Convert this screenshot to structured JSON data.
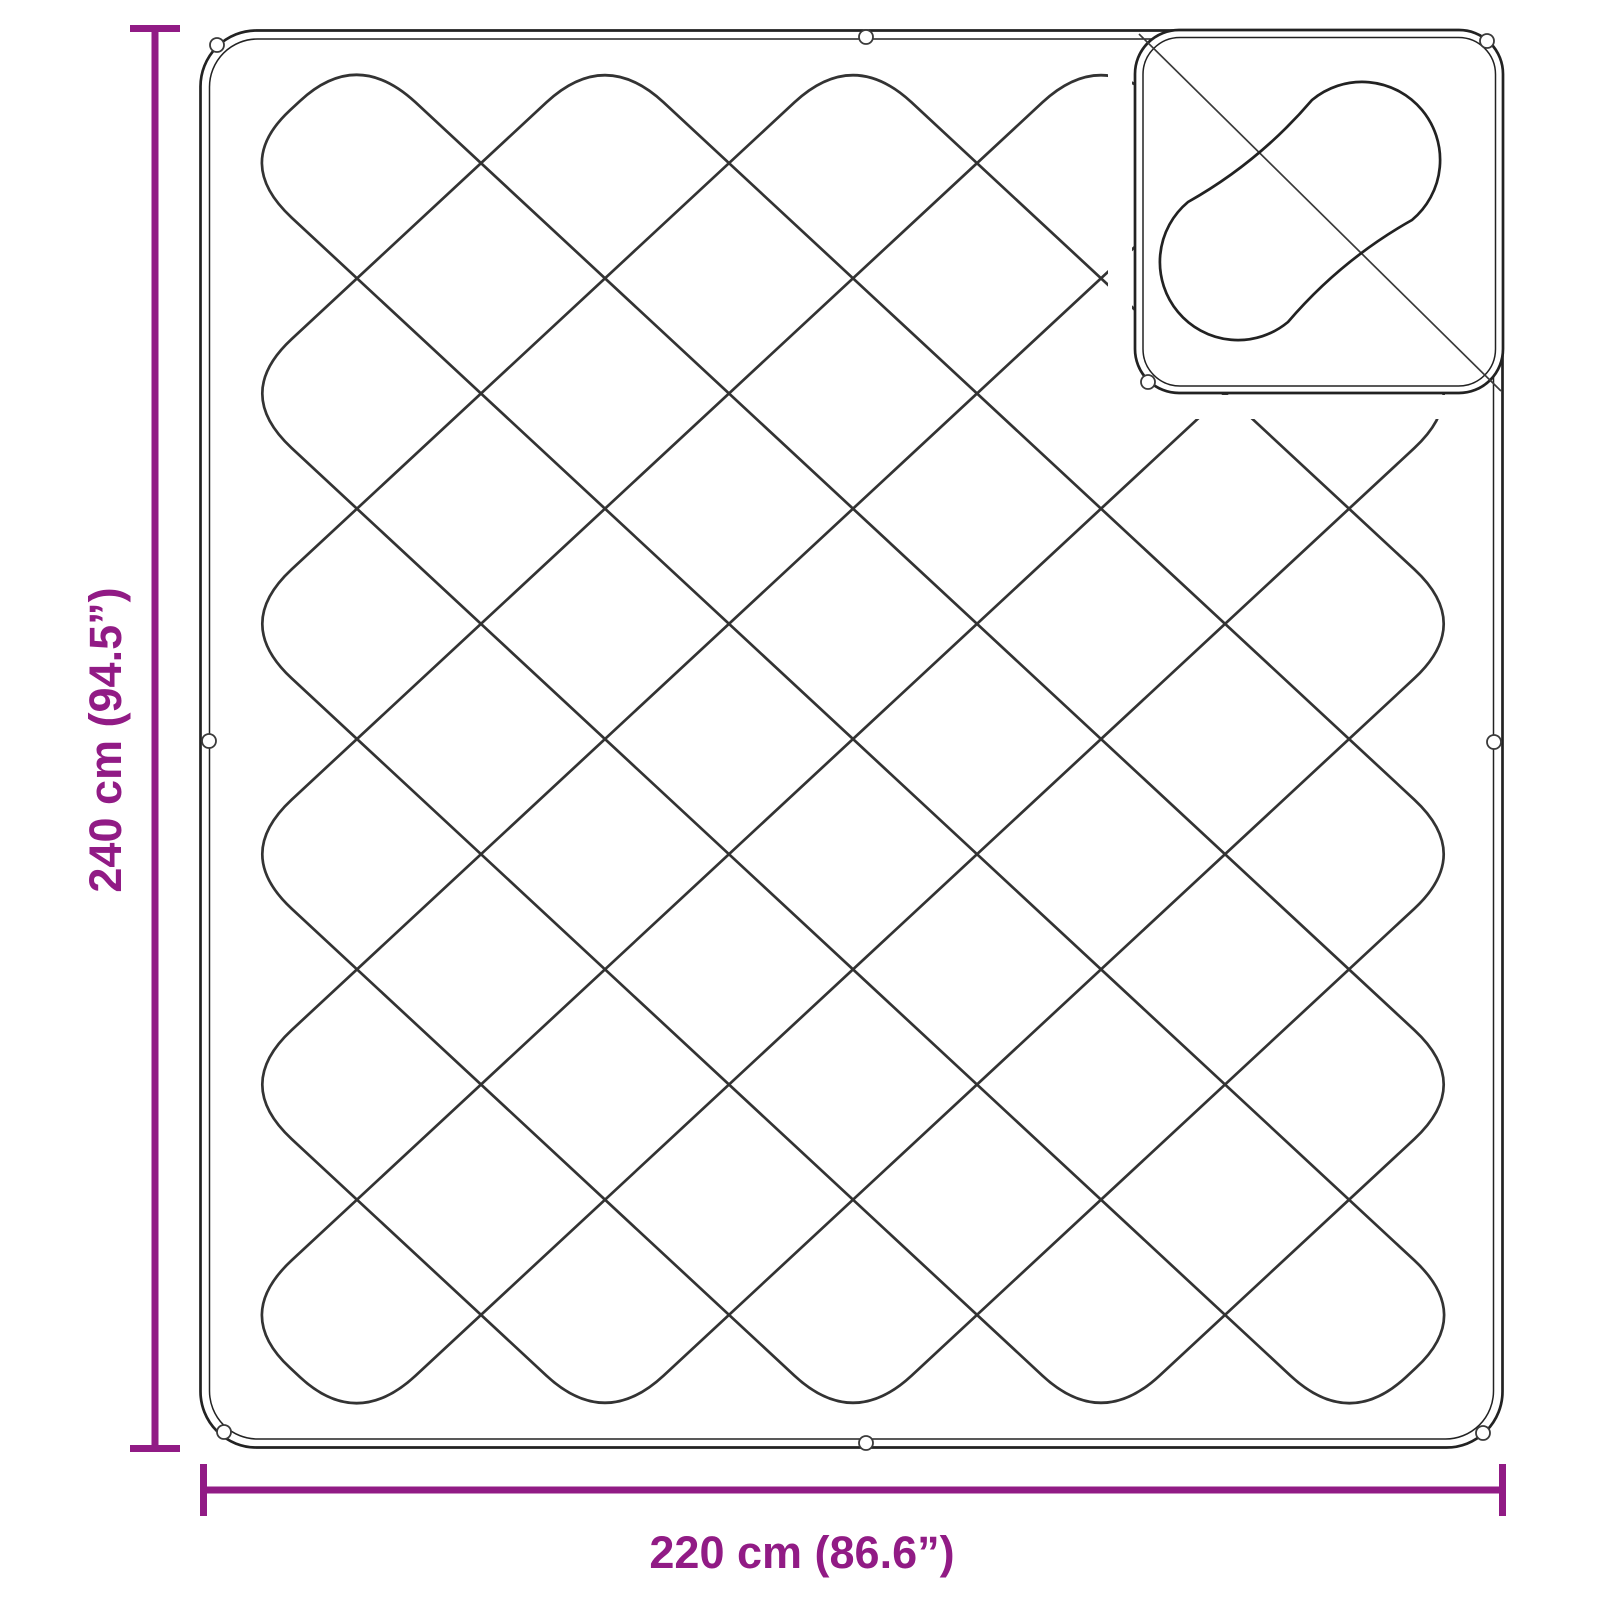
{
  "diagram": {
    "type": "product-dimension-diagram",
    "subject": "quilted blanket with folded corner",
    "height_label": "240 cm (94.5”)",
    "width_label": "220 cm (86.6”)",
    "accent_color": "#911b85",
    "line_color": "#222222",
    "crease_color": "#3a3a3a",
    "background_color": "#ffffff",
    "icons": {
      "eyelet_icon": "small circle fastener along blanket edges",
      "stitch_capsule_icon": "rounded capsule quilting stitch on folded corner",
      "fold_crease_icon": "diagonal fold crease line"
    }
  }
}
